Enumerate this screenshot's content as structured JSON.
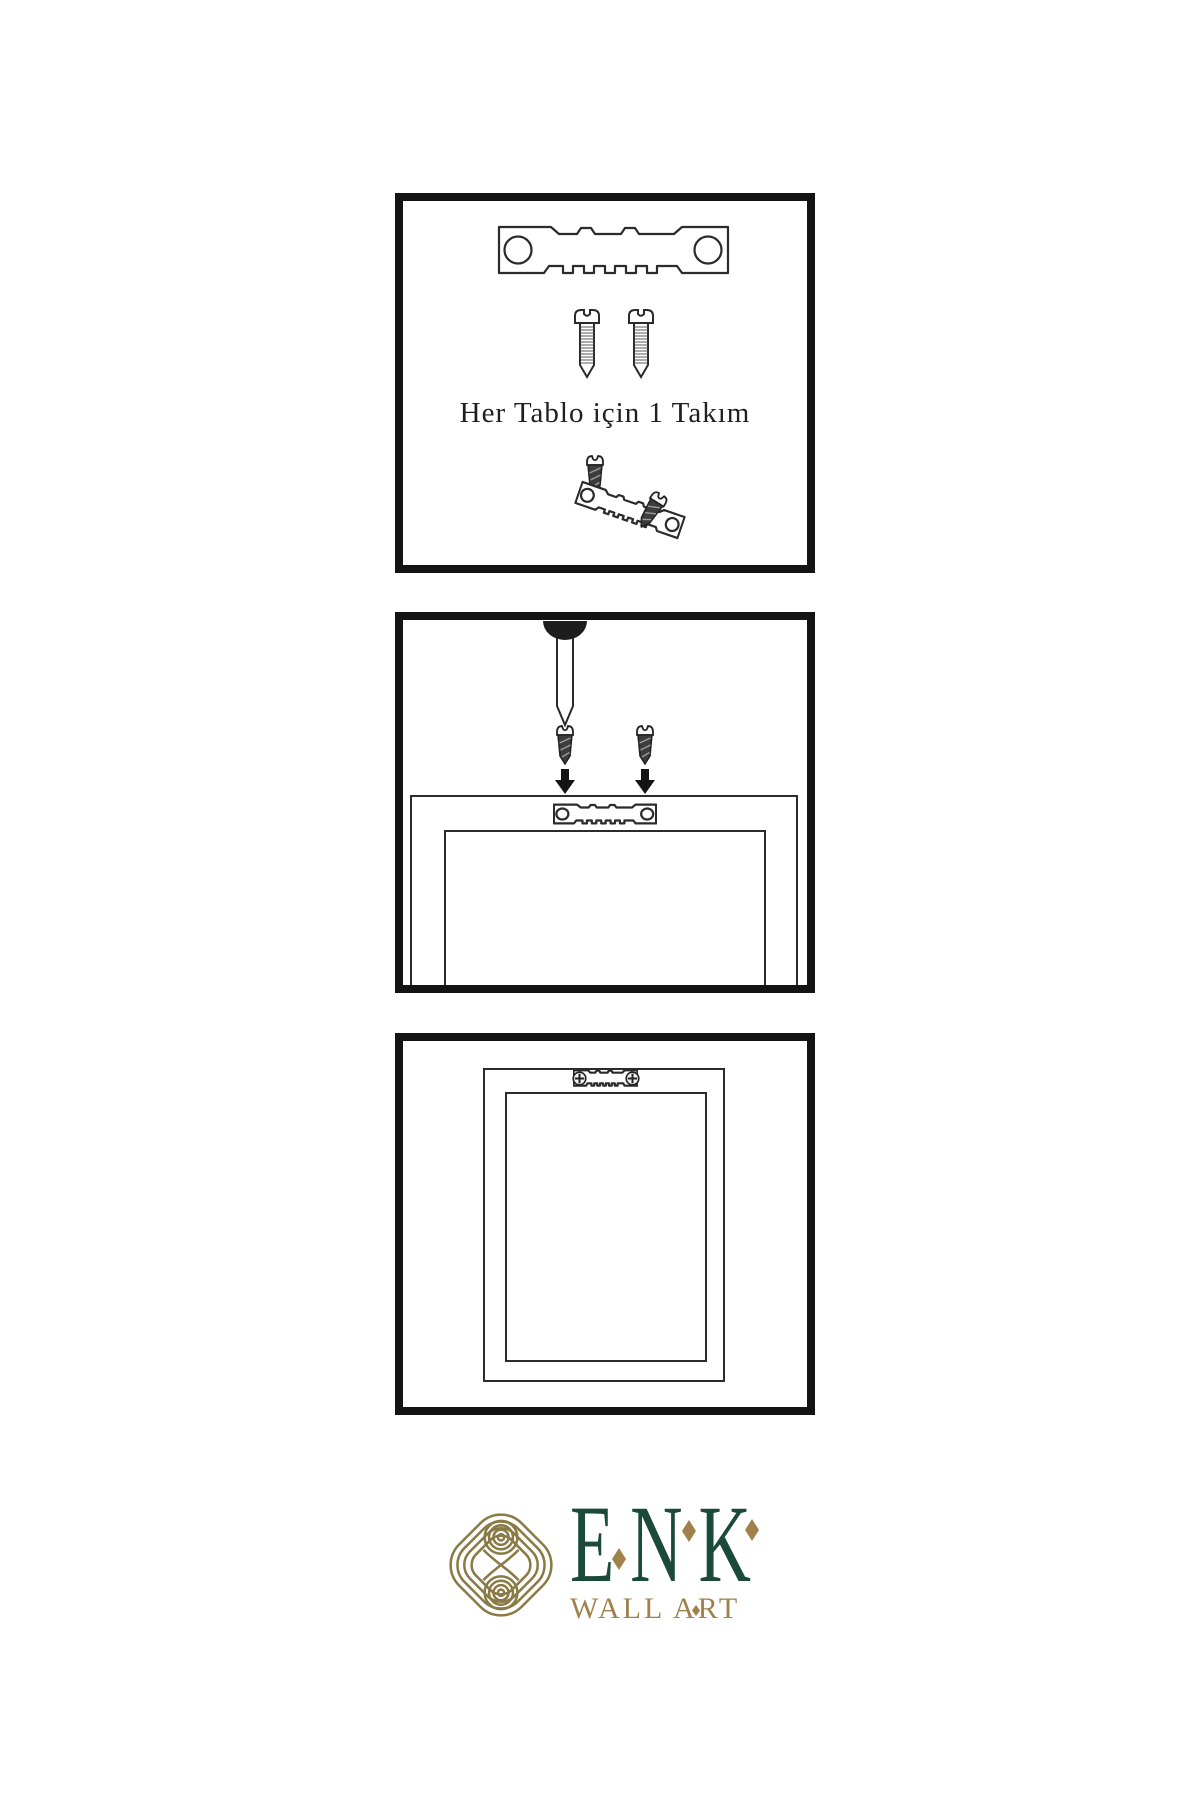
{
  "sheet": {
    "background": "#ffffff",
    "ink_color": "#2b2b2b",
    "panel_border_color": "#141414"
  },
  "panels": [
    {
      "name": "hardware-kit",
      "caption": "Her Tablo için 1 Takım",
      "items": [
        "sawtooth-hanger",
        "screw",
        "screw",
        "dark-screw",
        "tilted-sawtooth-hanger",
        "tilted-dark-screw"
      ]
    },
    {
      "name": "wall-mounting",
      "items": [
        "wall-nail",
        "dark-screw",
        "down-arrow",
        "dark-screw",
        "down-arrow",
        "frame-back-outline",
        "sawtooth-hanger"
      ]
    },
    {
      "name": "mounted-frame",
      "items": [
        "frame-back-outline",
        "inner-frame-outline",
        "sawtooth-hanger-with-screws"
      ]
    }
  ],
  "logo": {
    "brand": "ENK",
    "subtitle": "WALL ART",
    "knot_color": "#8a7a46",
    "brand_color": "#1c4a3a",
    "accent_gold": "#a0814b"
  }
}
